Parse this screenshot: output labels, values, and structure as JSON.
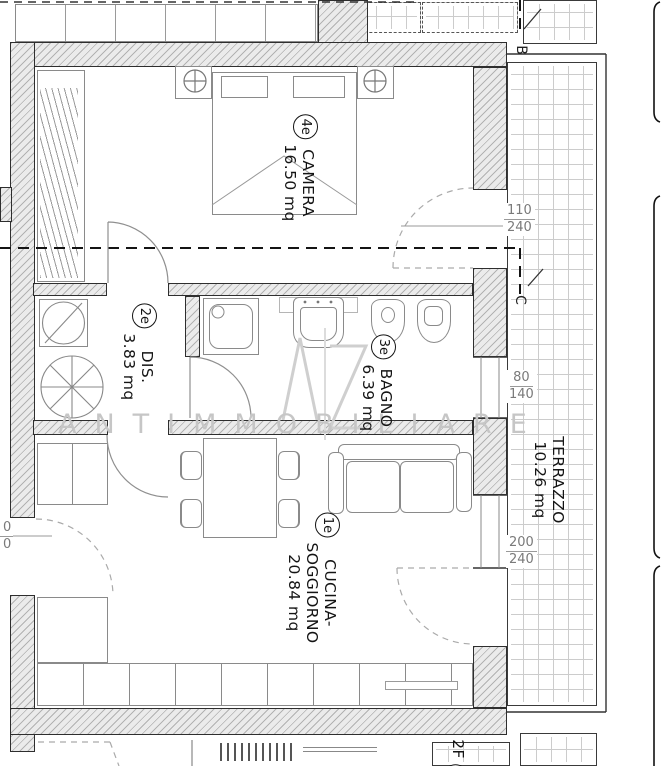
{
  "watermark": {
    "letters": "ANTIMMOBILIARE",
    "monogram": "AZ"
  },
  "rooms": [
    {
      "id": "4e",
      "name": "CAMERA",
      "area": "16.50 mq"
    },
    {
      "id": "2e",
      "name": "DIS.",
      "area": "3.83 mq"
    },
    {
      "id": "3e",
      "name": "BAGNO",
      "area": "6.39 mq"
    },
    {
      "id": "1e",
      "name": "CUCINA-",
      "name2": "SOGGIORNO",
      "area": "20.84 mq"
    },
    {
      "name": "TERRAZZO",
      "area": "10.26 mq"
    }
  ],
  "dimensions": [
    {
      "w": "110",
      "h": "240"
    },
    {
      "w": "80",
      "h": "140"
    },
    {
      "w": "200",
      "h": "240"
    },
    {
      "w": "0",
      "h": "0"
    }
  ],
  "markers": {
    "b": "B",
    "c": "C"
  },
  "neighbor_label": {
    "text": "2F",
    "id": "e"
  }
}
